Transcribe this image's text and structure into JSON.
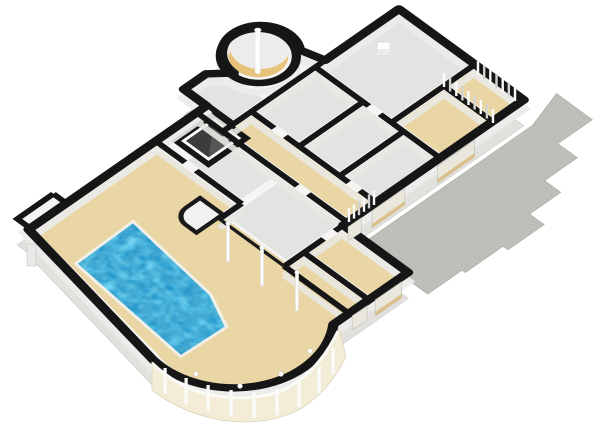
{
  "scene": {
    "title": "3D floor plan render",
    "view": "isometric-3d-dollhouse",
    "features": [
      "swimming-pool",
      "round-turret",
      "spiral-stair-pole",
      "curved-conservatory-wall",
      "paved-patio-with-steps",
      "built-in-wardrobe-slats",
      "stairwell-void",
      "pool-hall-columns",
      "exterior-windows",
      "bay-projection-west"
    ],
    "rooms": [
      {
        "name": "garage",
        "floor": "gray"
      },
      {
        "name": "wardrobe-room-north",
        "floor": "tan"
      },
      {
        "name": "wardrobe-room-south",
        "floor": "tan"
      },
      {
        "name": "utility-room-1",
        "floor": "gray"
      },
      {
        "name": "utility-room-2",
        "floor": "gray"
      },
      {
        "name": "utility-room-3",
        "floor": "gray"
      },
      {
        "name": "hallway",
        "floor": "tan"
      },
      {
        "name": "room-sw-1",
        "floor": "gray"
      },
      {
        "name": "room-sw-2",
        "floor": "gray"
      },
      {
        "name": "entry-porch",
        "floor": "gray"
      },
      {
        "name": "turret-stair",
        "floor": "tan"
      },
      {
        "name": "stairwell-void",
        "floor": "dark"
      },
      {
        "name": "bedroom-east-1",
        "floor": "tan"
      },
      {
        "name": "bedroom-east-2",
        "floor": "tan"
      },
      {
        "name": "pool-hall",
        "floor": "tan"
      },
      {
        "name": "conservatory",
        "floor": "tan"
      }
    ]
  },
  "colors": {
    "wall": "#161616",
    "slab": "#f5f5f3",
    "face_mid": "#efeeeb",
    "face_deep": "#e2e1dd",
    "face_shade": "#e8e8e4",
    "floor_tan": "#e9d6a4",
    "floor_gray": "#e3e3e2",
    "pool_water": "#2aa5da",
    "pool_coping": "#f0efe8",
    "patio": "#c9c9c4",
    "stair_void": "#3c3c3c",
    "conservatory_panel": "#f3ecd6",
    "window_glass": "#e9e6dc",
    "window_sill": "#dcc089",
    "turret_floor": "#e7c27a",
    "post_white": "#fdfdfd"
  }
}
